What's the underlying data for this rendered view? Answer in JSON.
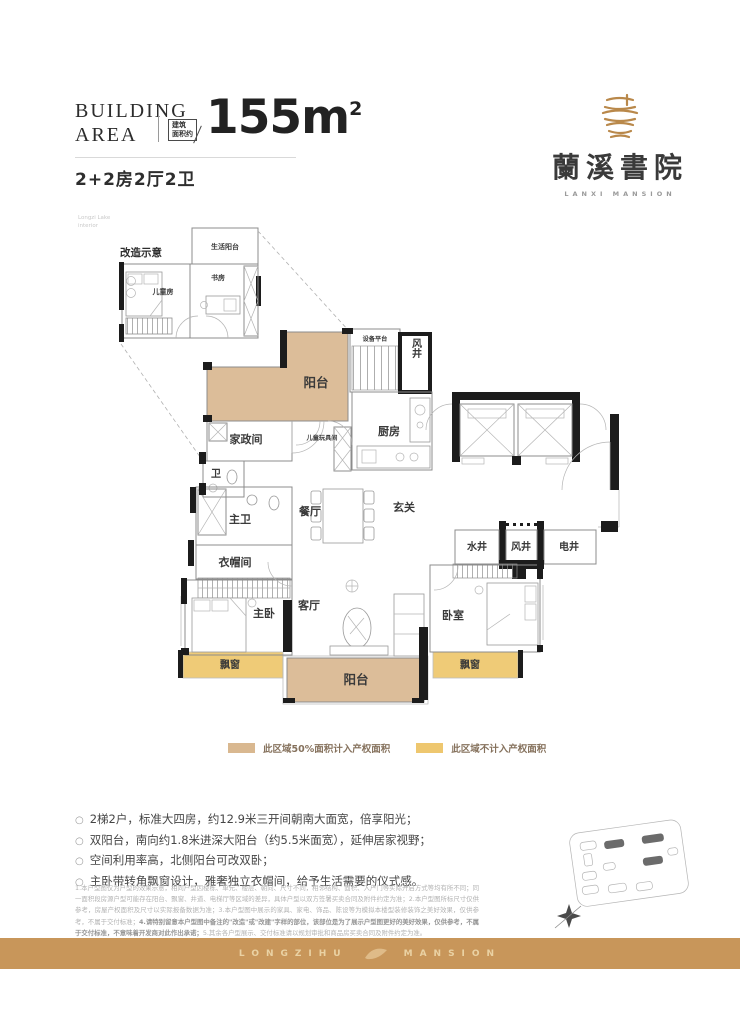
{
  "header": {
    "building_line1": "BUILDING",
    "building_line2": "AREA",
    "area_box_line1": "建筑",
    "area_box_line2": "面积约",
    "area_value": "155m",
    "area_sup": "2",
    "unit_type": "2+2房2厅2卫"
  },
  "logo": {
    "name_cn": "蘭溪書院",
    "name_en": "LANXI MANSION"
  },
  "inset": {
    "note_line1": "Longzi Lake",
    "note_line2": "interior",
    "title": "改造示意",
    "rooms": {
      "life_balcony": "生活阳台",
      "study": "书房",
      "kids_room": "儿童房"
    }
  },
  "floor_plan": {
    "rooms": {
      "balcony_north": "阳台",
      "housekeeping": "家政间",
      "kids_play": "儿童玩具间",
      "bath2": "卫",
      "kitchen": "厨房",
      "equipment_platform": "设备平台",
      "wind_shaft_top": "风井",
      "dining": "餐厅",
      "foyer": "玄关",
      "water_shaft": "水井",
      "wind_shaft": "风井",
      "electric_shaft": "电井",
      "master_bath": "主卫",
      "cloakroom": "衣帽间",
      "master_bedroom": "主卧",
      "living_room": "客厅",
      "bedroom2": "卧室",
      "bay_window_left": "飘窗",
      "bay_window_right": "飘窗",
      "balcony_south": "阳台"
    }
  },
  "legend": {
    "items": [
      {
        "label": "此区域50%面积计入产权面积",
        "color": "#d9b890"
      },
      {
        "label": "此区域不计入产权面积",
        "color": "#eec76f"
      }
    ]
  },
  "features": {
    "marker": "○",
    "items": [
      "2梯2户，标准大四房，约12.9米三开间朝南大面宽，倍享阳光；",
      "双阳台，南向约1.8米进深大阳台（约5.5米面宽），延伸居家视野；",
      "空间利用率高，北侧阳台可改双卧；",
      "主卧带转角飘窗设计，雅奢独立衣帽间，给予生活需要的仪式感。"
    ]
  },
  "disclaimer": {
    "part1": "1.本户型图仅为户型的效果示意，相同户型因楼栋、单元、楼层、朝向、尺寸不同，相邻结构、面积、入户门等实际开启方式等均有所不同；同一面积段房源户型可能存在阳台、飘窗、井道、电梯厅等区域的差异，具体户型以双方签署买卖合同及附件约定为准；2.本户型图所标尺寸仅供参考，房屋产权面积及尺寸以实际报备数据为准；3.本户型图中展示的家具、家电、饰品、陈设等为模拟本楼型装修装饰之美好效果，仅供参考，不属于交付标准；",
    "part2": "4.请特别留意本户型图中备注的\"改造\"或\"改建\"字样的部位，该部位是为了展示户型图更好的美好效果，仅供参考，不属于交付标准，不意味着开发商对此作出承诺；",
    "part3": "5.其余各户型展示、交付标准请以规划审批和商品房买卖合同及附件约定为准。"
  },
  "footer": {
    "brand_left": "LONGZIHU",
    "brand_right": "MANSION"
  },
  "colors": {
    "balcony_fill": "#dcbd99",
    "bay_window_fill": "#efcb77",
    "footer_band": "#c8965a",
    "logo_gold": "#b9884a",
    "wall": "#1c1c1c"
  }
}
